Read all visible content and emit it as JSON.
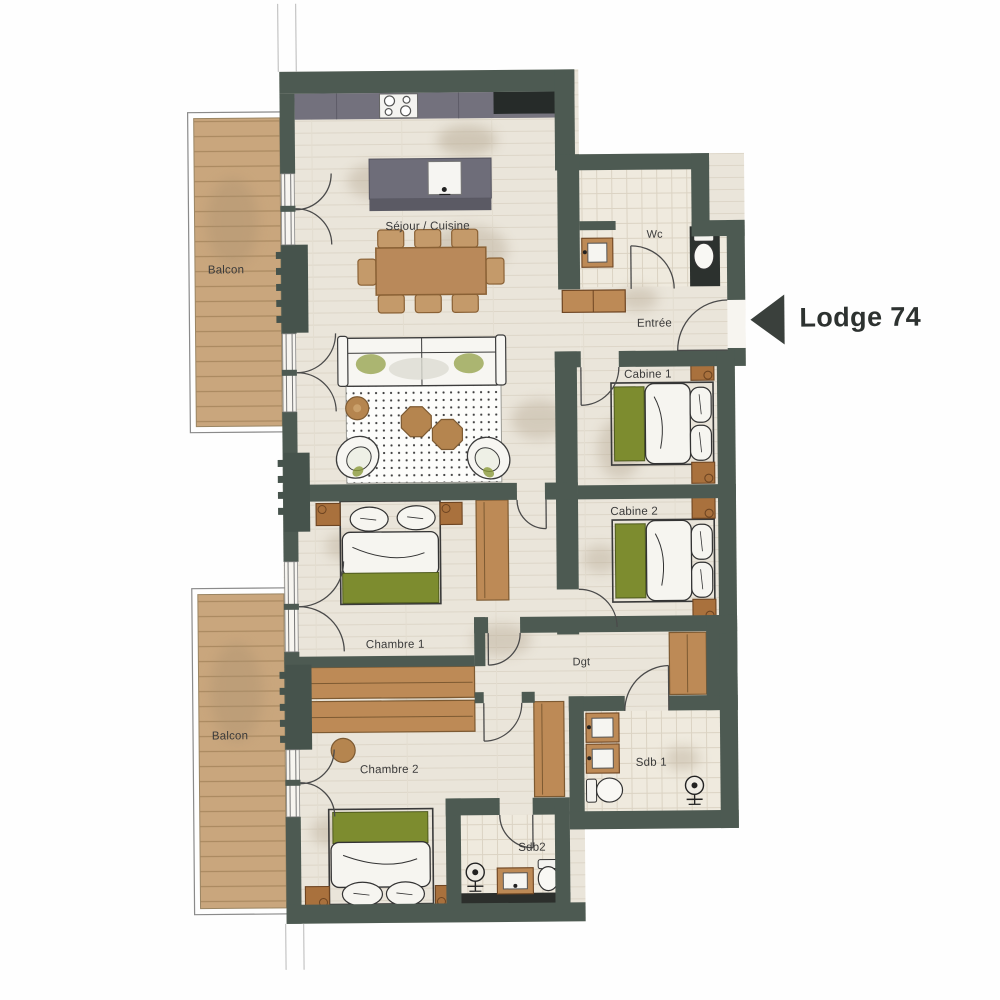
{
  "unit": {
    "name": "Lodge 74"
  },
  "rooms": {
    "balcon_top": "Balcon",
    "sejour_cuisine": "Séjour / Cuisine",
    "wc": "Wc",
    "entree": "Entrée",
    "cabine1": "Cabine 1",
    "cabine2": "Cabine 2",
    "chambre1": "Chambre 1",
    "chambre2": "Chambre 2",
    "degagement": "Dgt",
    "sdb1": "Sdb 1",
    "sdb2": "Sdb2",
    "balcon_bottom": "Balcon"
  },
  "colors": {
    "wall": "#4d5a52",
    "floor": "#eae5da",
    "tile": "#efeade",
    "balcony_wood": "#c9a67d",
    "furniture_wood": "#bd8a56",
    "table_wood": "#b9895a",
    "bed_green": "#7d8c2f",
    "sofa_green": "#8a9a3a",
    "kitchen_counter": "#73717d",
    "dark_fixture": "#262b29",
    "arrow": "#3a403c",
    "label_text": "#3a3a3a"
  }
}
